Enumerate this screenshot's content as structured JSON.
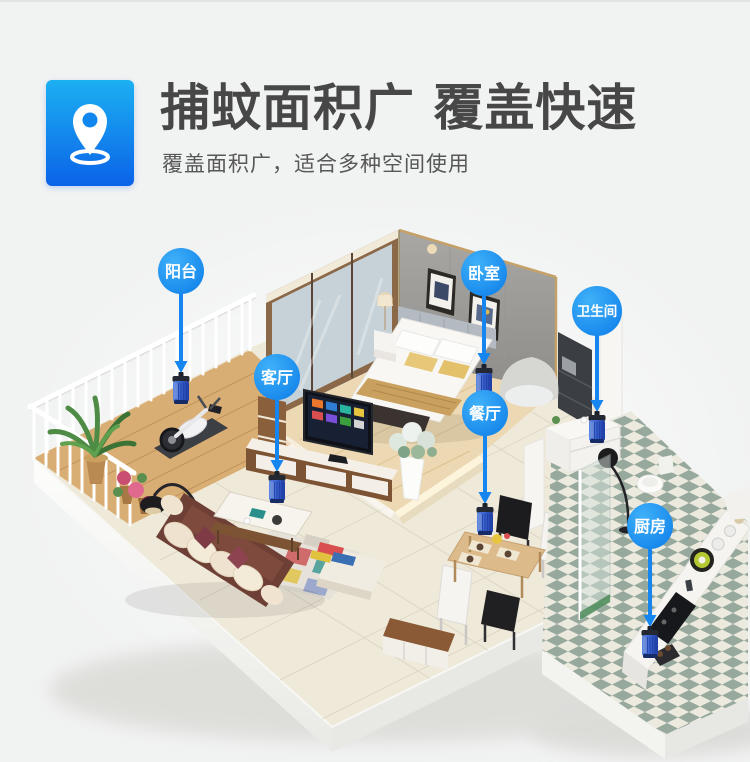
{
  "header": {
    "title": "捕蚊面积广 覆盖快速",
    "subtitle": "覆盖面积广，适合多种空间使用",
    "title_color": "#474747",
    "icon": {
      "name": "location-pin-icon",
      "gradient_top": "#1cb0f2",
      "gradient_bottom": "#0b63e8"
    }
  },
  "diagram": {
    "bubble_gradient": [
      "#3fb1f9",
      "#0b7ce8"
    ],
    "label_color": "#ffffff",
    "arrow_color": "#1585f0",
    "device_colors": [
      "#5b87e4",
      "#3c63cf",
      "#1f3da6"
    ],
    "rooms": [
      {
        "id": "balcony",
        "label": "阳台",
        "label_x": 181,
        "label_y": 271,
        "device_x": 181,
        "device_y": 391
      },
      {
        "id": "living-room",
        "label": "客厅",
        "label_x": 277,
        "label_y": 377,
        "device_x": 277,
        "device_y": 490
      },
      {
        "id": "bedroom",
        "label": "卧室",
        "label_x": 484,
        "label_y": 273,
        "device_x": 484,
        "device_y": 383
      },
      {
        "id": "bathroom",
        "label": "卫生间",
        "label_x": 597,
        "label_y": 311,
        "device_x": 597,
        "device_y": 430
      },
      {
        "id": "dining-room",
        "label": "餐厅",
        "label_x": 485,
        "label_y": 413,
        "device_x": 485,
        "device_y": 522
      },
      {
        "id": "kitchen",
        "label": "厨房",
        "label_x": 650,
        "label_y": 526,
        "device_x": 650,
        "device_y": 645
      }
    ]
  }
}
